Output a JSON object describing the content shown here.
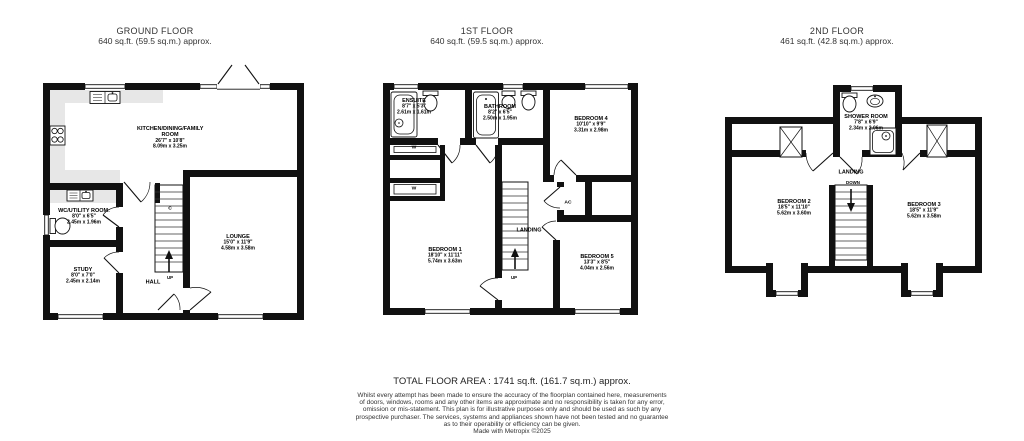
{
  "colors": {
    "wall": "#111111",
    "counter": "#e7e7e7",
    "background": "#ffffff"
  },
  "floors": [
    {
      "id": "ground",
      "title": "GROUND FLOOR",
      "area": "640 sq.ft. (59.5 sq.m.) approx.",
      "rooms": [
        {
          "name": "KITCHEN/DINING/FAMILY ROOM",
          "imperial": "26'7\" x 10'8\"",
          "metric": "8.09m x 3.25m"
        },
        {
          "name": "WC/UTILITY ROOM:",
          "imperial": "8'0\" x 6'5\"",
          "metric": "2.45m x 1.96m"
        },
        {
          "name": "STUDY",
          "imperial": "8'0\" x 7'0\"",
          "metric": "2.45m x 2.14m"
        },
        {
          "name": "LOUNGE",
          "imperial": "15'0\" x 11'9\"",
          "metric": "4.58m x 3.58m"
        },
        {
          "name": "HALL"
        }
      ],
      "annotations": {
        "cupboard": "C",
        "up": "UP"
      }
    },
    {
      "id": "first",
      "title": "1ST FLOOR",
      "area": "640 sq.ft. (59.5 sq.m.) approx.",
      "rooms": [
        {
          "name": "ENSUITE",
          "imperial": "8'7\" x 5'3\"",
          "metric": "2.61m x 1.61m"
        },
        {
          "name": "BATHROOM",
          "imperial": "8'2\" x 6'5\"",
          "metric": "2.50m x 1.95m"
        },
        {
          "name": "BEDROOM 4",
          "imperial": "10'10\" x 9'9\"",
          "metric": "3.31m x 2.98m"
        },
        {
          "name": "BEDROOM 1",
          "imperial": "18'10\" x 11'11\"",
          "metric": "5.74m x 3.63m"
        },
        {
          "name": "BEDROOM 5",
          "imperial": "13'3\" x 8'5\"",
          "metric": "4.04m x 2.56m"
        },
        {
          "name": "LANDING"
        }
      ],
      "annotations": {
        "ac": "AC",
        "wardrobe": "W",
        "up": "UP"
      }
    },
    {
      "id": "second",
      "title": "2ND FLOOR",
      "area": "461 sq.ft. (42.8 sq.m.) approx.",
      "rooms": [
        {
          "name": "SHOWER ROOM",
          "imperial": "7'8\" x 6'9\"",
          "metric": "2.34m x 2.06m"
        },
        {
          "name": "BEDROOM 2",
          "imperial": "18'5\" x 11'10\"",
          "metric": "5.62m x 3.60m"
        },
        {
          "name": "BEDROOM 3",
          "imperial": "18'5\" x 11'9\"",
          "metric": "5.62m x 3.58m"
        },
        {
          "name": "LANDING"
        }
      ],
      "annotations": {
        "down": "DOWN"
      }
    }
  ],
  "footer": {
    "total": "TOTAL FLOOR AREA : 1741 sq.ft. (161.7 sq.m.) approx.",
    "disclaimer_lines": [
      "Whilst every attempt has been made to ensure the accuracy of the floorplan contained here, measurements",
      "of doors, windows, rooms and any other items are approximate and no responsibility is taken for any error,",
      "omission or mis-statement. This plan is for illustrative purposes only and should be used as such by any",
      "prospective purchaser. The services, systems and appliances shown have not been tested and no guarantee",
      "as to their operability or efficiency can be given.",
      "Made with Metropix ©2025"
    ]
  }
}
